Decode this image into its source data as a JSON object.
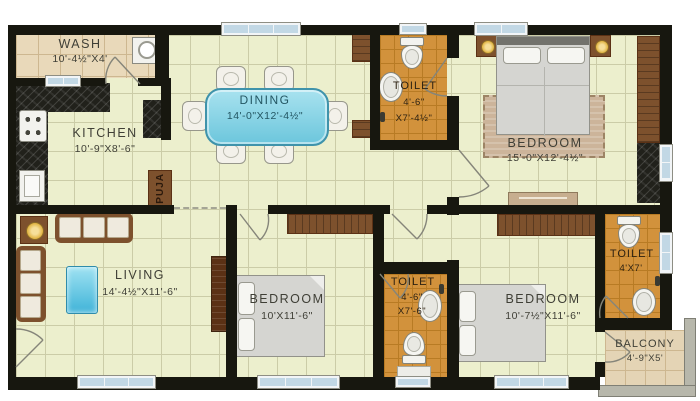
{
  "rooms": {
    "wash": {
      "label": "WASH",
      "dims": "10'-4½\"X4'"
    },
    "kitchen": {
      "label": "KITCHEN",
      "dims": "10'-9\"X8'-6\""
    },
    "dining": {
      "label": "DINING",
      "dims": "14'-0\"X12'-4½\""
    },
    "toilet_top": {
      "label": "TOILET",
      "dims_l1": "4'-6\"",
      "dims_l2": "X7'-4½\""
    },
    "bedroom_master": {
      "label": "BEDROOM",
      "dims": "15'-0\"X12'-4½\""
    },
    "living": {
      "label": "LIVING",
      "dims": "14'-4½\"X11'-6\""
    },
    "bedroom_middle": {
      "label": "BEDROOM",
      "dims": "10'X11'-6\""
    },
    "toilet_bottom": {
      "label": "TOILET",
      "dims_l1": "4'-6\"",
      "dims_l2": "X7'-6\""
    },
    "bedroom_right": {
      "label": "BEDROOM",
      "dims": "10'-7½\"X11'-6\""
    },
    "toilet_right": {
      "label": "TOILET",
      "dims": "4'X7'"
    },
    "balcony": {
      "label": "BALCONY",
      "dims": "4'-9\"X5'"
    },
    "puja": {
      "label": "PUJA"
    }
  },
  "colors": {
    "wall": "#17170f",
    "floor": "#ecefcd",
    "floor_line": "#cbcca7",
    "wash_floor": "#e9d9ba",
    "wash_line": "#cdb790",
    "toilet_floor": "#d2923c",
    "toilet_line": "#b87b24",
    "balcony_floor": "#e4d4b5",
    "wood": "#7d512d",
    "wood_dark": "#5b3115",
    "bed": "#d5d5d1",
    "rug": "#ccb49a",
    "table_cyan": "#7fd4e6",
    "window": "#c2d8e5",
    "granite": "#21211b",
    "label": "#3f3f36"
  }
}
